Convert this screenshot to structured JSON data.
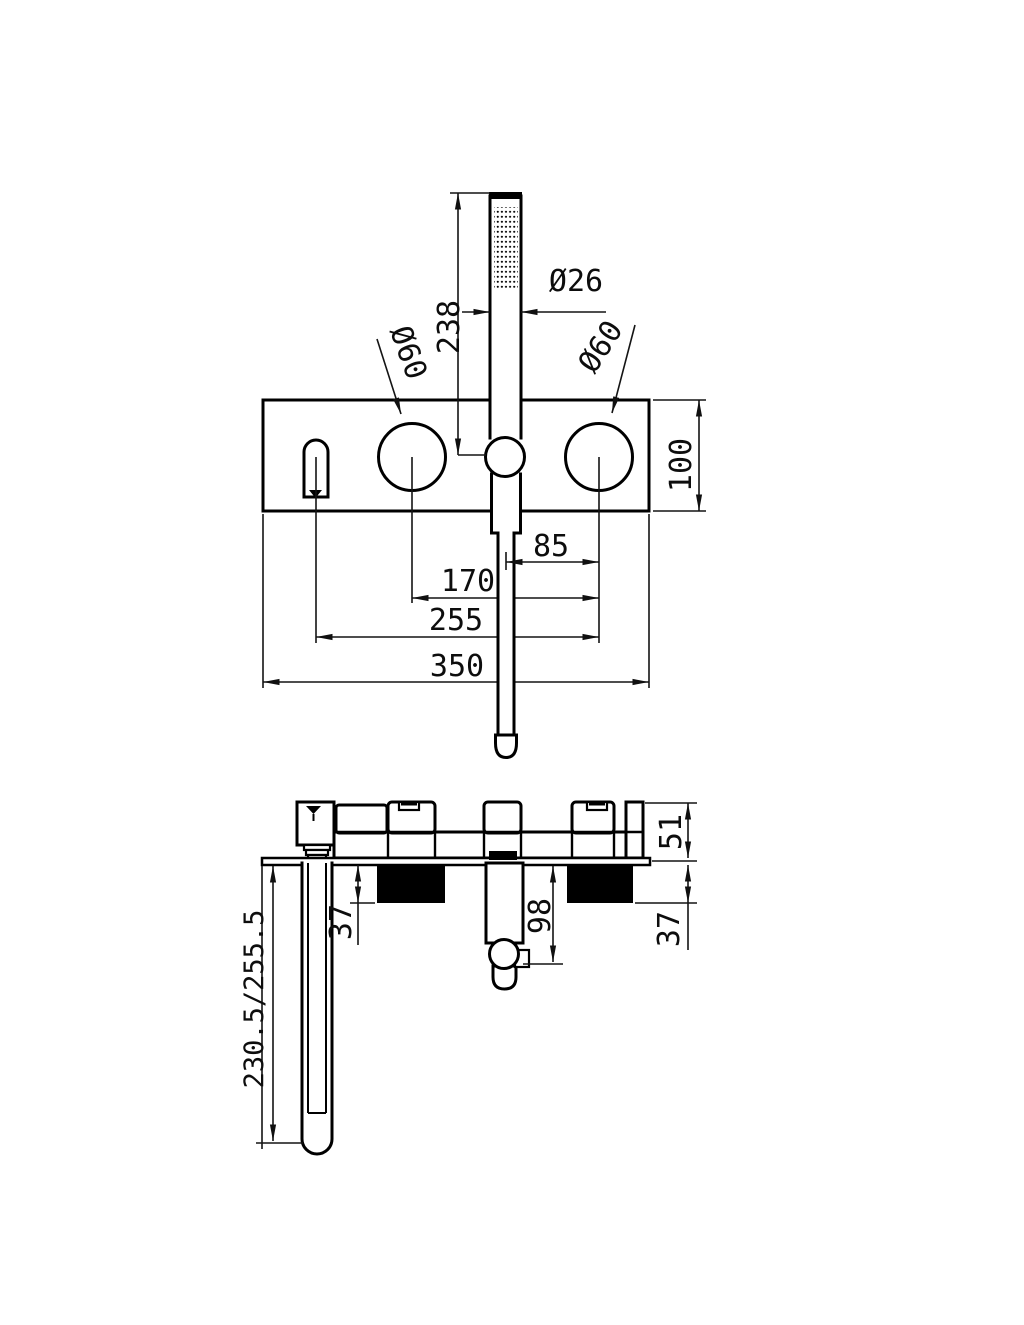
{
  "drawing": {
    "title": "bath-shower-mixer-dimension-drawing",
    "front_view": {
      "hand_shower_dia": "Ø26",
      "hand_shower_length": "238",
      "left_knob_dia": "Ø60",
      "right_knob_dia": "Ø60",
      "plate_height": "100",
      "holder_to_knob": "85",
      "knob_to_knob": "170",
      "spout_to_knob": "255",
      "plate_width": "350"
    },
    "side_view": {
      "body_depth": "51",
      "rough_in_depth_left": "37",
      "rough_in_depth_right": "37",
      "holder_depth": "98",
      "spout_length": "230.5/255.5"
    }
  }
}
